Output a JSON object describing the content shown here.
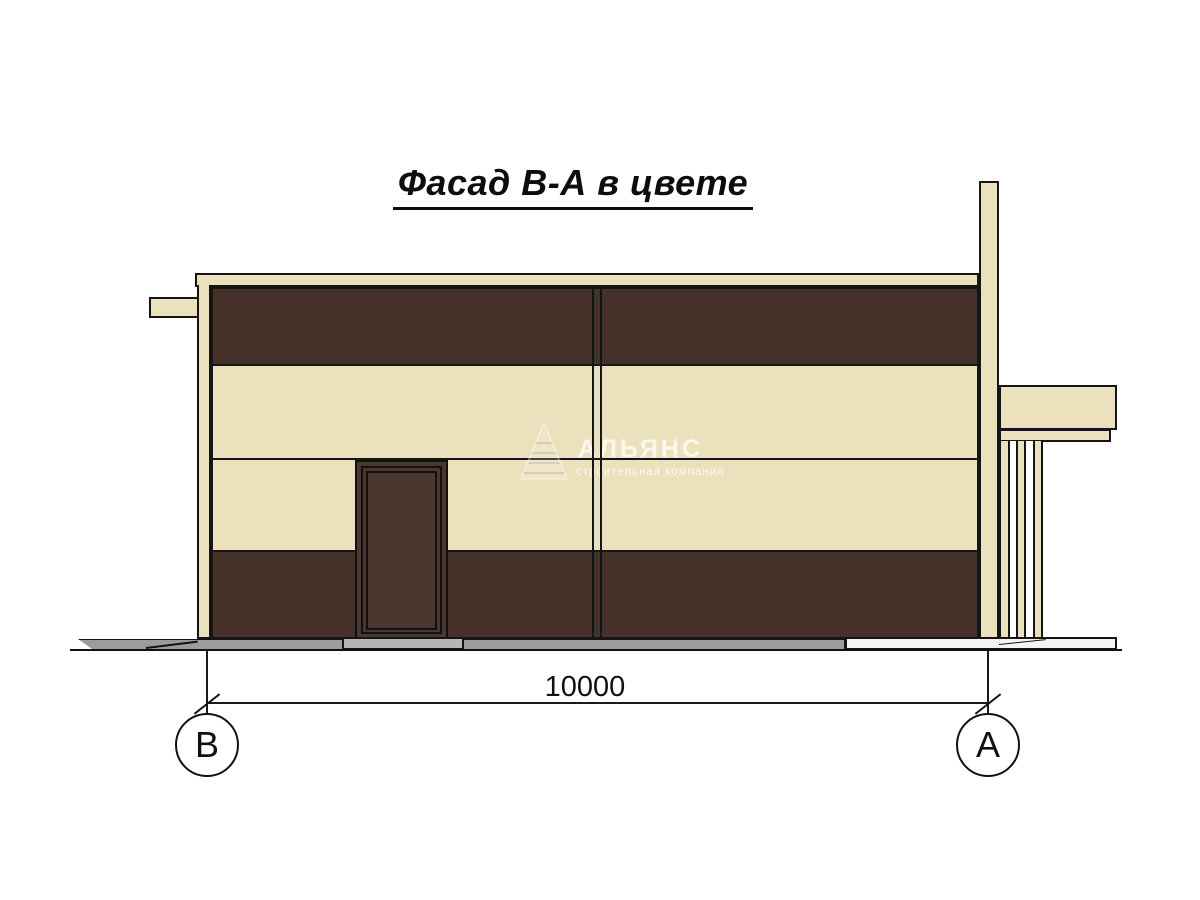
{
  "title": "Фасад В-А в цвете",
  "dimension": {
    "value": "10000"
  },
  "axis_markers": {
    "left": "В",
    "right": "А"
  },
  "watermark": {
    "name": "АЛЬЯНС",
    "tagline": "строительная компания"
  },
  "colors": {
    "cream": "#ECE1BD",
    "brown": "#45312A",
    "door": "#4B372F",
    "pavement": "#9C9C9C",
    "step": "#B5B5B5",
    "outline": "#151515"
  }
}
